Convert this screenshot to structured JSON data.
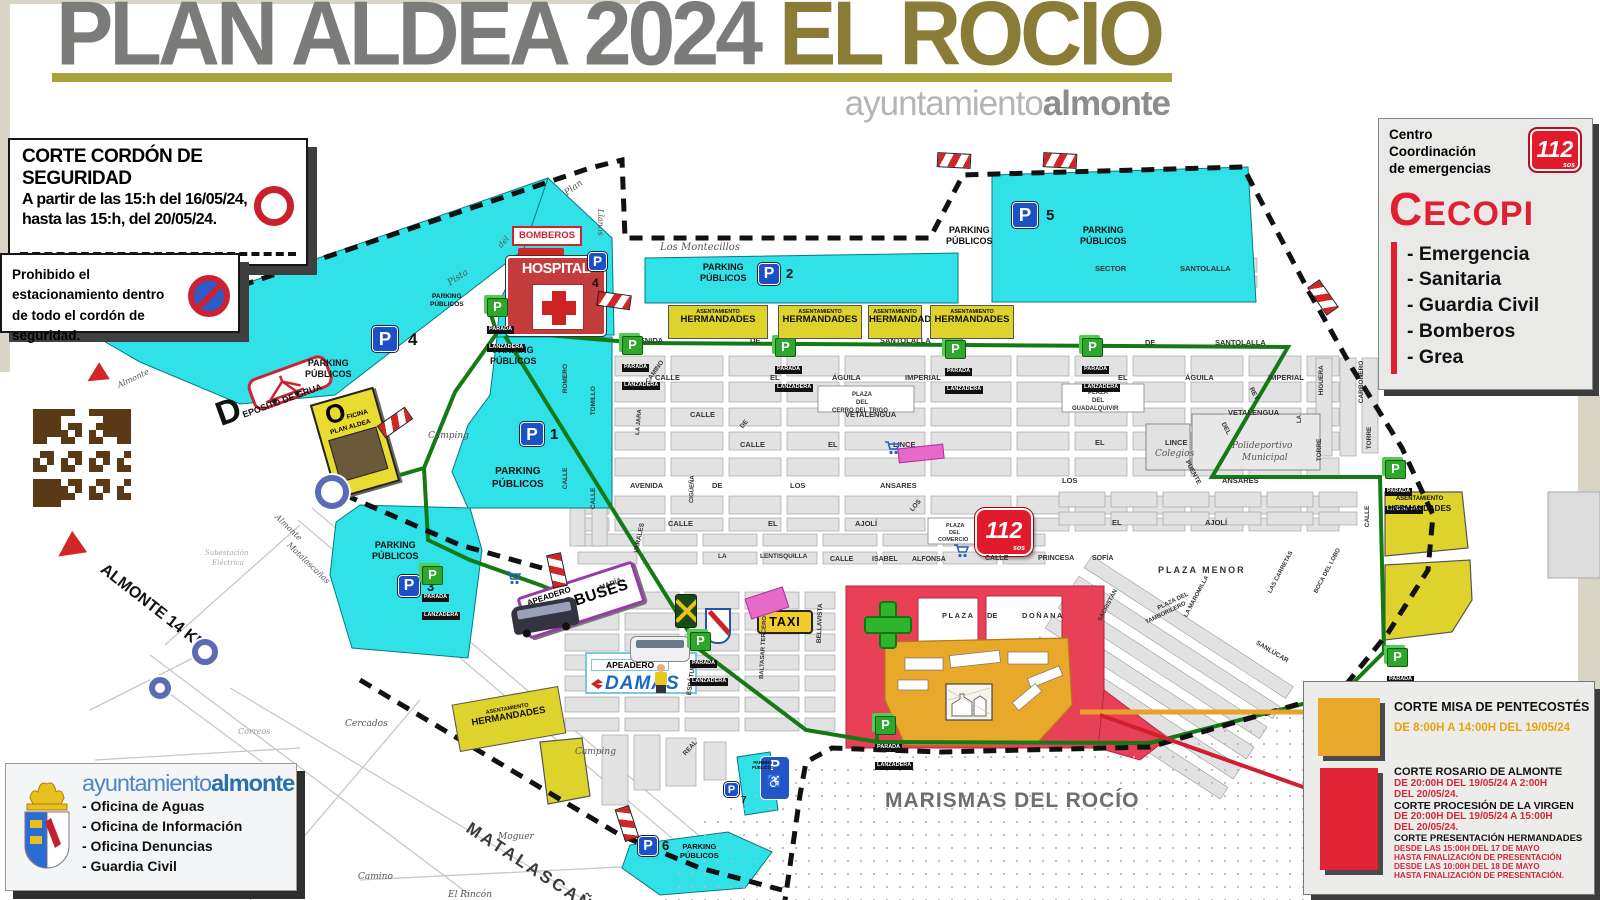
{
  "header": {
    "title_main": "PLAN ALDEA 2024 ",
    "title_accent": "EL ROCÍO",
    "brand_light": "ayuntamiento",
    "brand_bold": "almonte"
  },
  "security_box": {
    "title": "CORTE CORDÓN DE SEGURIDAD",
    "line1": "A partir de las 15:h del 16/05/24,",
    "line2": "hasta las 15:h, del 20/05/24."
  },
  "no_parking_box": {
    "line1": "Prohibido el estacionamiento dentro",
    "line2": "de todo el cordón de seguridad."
  },
  "cecopi": {
    "center_line1": "Centro",
    "center_line2": "Coordinación",
    "center_line3": "de emergencias",
    "logo": "112",
    "logo_sub": "sos",
    "name_first": "C",
    "name_rest": "ECOPI",
    "items": [
      "- Emergencia",
      "- Sanitaria",
      "- Guardia Civil",
      "- Bomberos",
      "- Grea"
    ]
  },
  "council_box": {
    "brand_light": "ayuntamiento",
    "brand_bold": "almonte",
    "items": [
      "- Oficina de Aguas",
      "- Oficina de Información",
      "- Oficina Denuncias",
      "- Guardia Civil"
    ]
  },
  "legend": {
    "misa_title": "CORTE MISA DE PENTECOSTÉS",
    "misa_time": "DE 8:00H A 14:00H DEL 19/05/24",
    "rosario_title": "CORTE ROSARIO DE ALMONTE",
    "rosario_time1": "DE 20:00H DEL 19/05/24 A 2:00H",
    "rosario_time2": "DEL 20/05/24.",
    "procesion_title": "CORTE PROCESIÓN DE LA VIRGEN",
    "procesion_time1": "DE 20:00H DEL 19/05/24 A 15:00H",
    "procesion_time2": "DEL 20/05/24.",
    "presentacion_title": "CORTE PRESENTACIÓN HERMANDADES",
    "presentacion_l1": "DESDE LAS 15:00H DEL 17 DE MAYO",
    "presentacion_l2": "HASTA FINALIZACIÓN DE PRESENTACIÓN",
    "presentacion_l3": "DESDE LAS 10:00H DEL 18 DE MAYO",
    "presentacion_l4": "HASTA FINALIZACIÓN DE PRESENTACIÓN."
  },
  "map": {
    "marismas_label": "MARISMAS DEL ROCÍO",
    "hospital_label": "HOSPITAL",
    "bomberos_label": "BOMBEROS",
    "taxi_label": "TAXI",
    "apeadero_label": "APEADERO",
    "autobuses_label": "AUTOBUSES",
    "damas_label": "DAMAS",
    "oficina_first": "O",
    "oficina_rest1": "FICINA",
    "oficina_rest2": "PLAN ALDEA",
    "deposito_label": "DEPOSITO DE GRUA",
    "parada_l1": "PARADA",
    "parada_l2": "LANZADERA",
    "herm_l1": "ASENTAMIENTO",
    "herm_l2": "HERMANDADES",
    "p_letter": "P",
    "p_name1": "PARKING",
    "p_name2": "PÚBLICOS",
    "emergency_logo": "112",
    "emergency_logo_sub": "sos",
    "wheelchair": "♿",
    "street_labels": [
      {
        "t": "Pista",
        "x": 449,
        "y": 280,
        "r": -33,
        "i": 1,
        "s": 9
      },
      {
        "t": "Plan",
        "x": 566,
        "y": 190,
        "r": -36,
        "i": 1,
        "s": 9
      },
      {
        "t": "del",
        "x": 500,
        "y": 243,
        "r": -50,
        "i": 1,
        "s": 8
      },
      {
        "t": "Llanos",
        "x": 600,
        "y": 205,
        "r": 90,
        "i": 1,
        "s": 8
      },
      {
        "t": "Los Montecillos",
        "x": 660,
        "y": 243,
        "i": 1,
        "s": 10
      },
      {
        "t": "SECTOR",
        "x": 1095,
        "y": 265
      },
      {
        "t": "SANTOLALLA",
        "x": 1180,
        "y": 265
      },
      {
        "t": "AVENIDA",
        "x": 630,
        "y": 337
      },
      {
        "t": "DE",
        "x": 750,
        "y": 337
      },
      {
        "t": "SANTOLALLA",
        "x": 880,
        "y": 337
      },
      {
        "t": "DE",
        "x": 1145,
        "y": 339
      },
      {
        "t": "SANTOLALLA",
        "x": 1215,
        "y": 339
      },
      {
        "t": "CALLE",
        "x": 655,
        "y": 374
      },
      {
        "t": "EL",
        "x": 770,
        "y": 374
      },
      {
        "t": "ÁGUILA",
        "x": 832,
        "y": 374
      },
      {
        "t": "IMPERIAL",
        "x": 905,
        "y": 374
      },
      {
        "t": "EL",
        "x": 1118,
        "y": 374
      },
      {
        "t": "ÁGUILA",
        "x": 1185,
        "y": 374
      },
      {
        "t": "IMPERIAL",
        "x": 1268,
        "y": 374
      },
      {
        "t": "CALLE",
        "x": 690,
        "y": 411
      },
      {
        "t": "VETALENGUA",
        "x": 845,
        "y": 411
      },
      {
        "t": "VETALENGUA",
        "x": 1228,
        "y": 409
      },
      {
        "t": "CALLE",
        "x": 740,
        "y": 441
      },
      {
        "t": "EL",
        "x": 828,
        "y": 441
      },
      {
        "t": "LINCE",
        "x": 893,
        "y": 441
      },
      {
        "t": "EL",
        "x": 1095,
        "y": 439
      },
      {
        "t": "LINCE",
        "x": 1165,
        "y": 439
      },
      {
        "t": "AVENIDA",
        "x": 630,
        "y": 482
      },
      {
        "t": "DE",
        "x": 712,
        "y": 482
      },
      {
        "t": "LOS",
        "x": 790,
        "y": 482
      },
      {
        "t": "ANSARES",
        "x": 880,
        "y": 482
      },
      {
        "t": "LOS",
        "x": 1062,
        "y": 477
      },
      {
        "t": "ANSARES",
        "x": 1222,
        "y": 477
      },
      {
        "t": "CALLE",
        "x": 668,
        "y": 520
      },
      {
        "t": "EL",
        "x": 768,
        "y": 520
      },
      {
        "t": "AJOLÍ",
        "x": 855,
        "y": 520
      },
      {
        "t": "EL",
        "x": 1112,
        "y": 519
      },
      {
        "t": "AJOLÍ",
        "x": 1205,
        "y": 519
      },
      {
        "t": "CALLE",
        "x": 830,
        "y": 556,
        "s": 7
      },
      {
        "t": "ISABEL",
        "x": 872,
        "y": 556,
        "s": 7
      },
      {
        "t": "ALFONSA",
        "x": 912,
        "y": 556,
        "s": 7
      },
      {
        "t": "CALLE",
        "x": 985,
        "y": 555,
        "s": 7
      },
      {
        "t": "PRINCESA",
        "x": 1038,
        "y": 555,
        "s": 7
      },
      {
        "t": "SOFÍA",
        "x": 1092,
        "y": 555,
        "s": 7
      },
      {
        "t": "LA",
        "x": 718,
        "y": 554,
        "s": 6.5
      },
      {
        "t": "LENTISQUILLA",
        "x": 760,
        "y": 554,
        "s": 6.5
      },
      {
        "t": "PLAZA MENOR",
        "x": 1158,
        "y": 566,
        "s": 9,
        "ls": 2
      },
      {
        "t": "PLAZA",
        "x": 942,
        "y": 612,
        "ls": 1.5
      },
      {
        "t": "DE",
        "x": 987,
        "y": 612
      },
      {
        "t": "DOÑANA",
        "x": 1022,
        "y": 612,
        "ls": 1.5
      },
      {
        "t": "Colegios",
        "x": 1155,
        "y": 450,
        "i": 1,
        "s": 9
      },
      {
        "t": "Polideportivo",
        "x": 1232,
        "y": 442,
        "i": 1,
        "s": 9
      },
      {
        "t": "Municipal",
        "x": 1242,
        "y": 454,
        "i": 1,
        "s": 9
      },
      {
        "t": "PLAZA",
        "x": 1088,
        "y": 390,
        "s": 6
      },
      {
        "t": "DEL",
        "x": 1092,
        "y": 398,
        "s": 6
      },
      {
        "t": "GUADALQUIVIR",
        "x": 1072,
        "y": 406,
        "s": 6
      },
      {
        "t": "PLAZA",
        "x": 852,
        "y": 392,
        "s": 6
      },
      {
        "t": "DEL",
        "x": 856,
        "y": 400,
        "s": 6
      },
      {
        "t": "CERRO DEL TRIGO",
        "x": 832,
        "y": 408,
        "s": 6
      },
      {
        "t": "PLAZA",
        "x": 946,
        "y": 524,
        "s": 5.5
      },
      {
        "t": "DEL",
        "x": 949,
        "y": 531,
        "s": 5.5
      },
      {
        "t": "COMERCIO",
        "x": 938,
        "y": 538,
        "s": 5.5
      },
      {
        "t": "PLAZA DEL",
        "x": 1158,
        "y": 606,
        "s": 6,
        "r": -26
      },
      {
        "t": "TAMBORILERO",
        "x": 1146,
        "y": 620,
        "s": 6,
        "r": -26
      },
      {
        "t": "Camping",
        "x": 428,
        "y": 432,
        "i": 1,
        "s": 9
      },
      {
        "t": "Camping",
        "x": 575,
        "y": 748,
        "i": 1,
        "s": 9
      },
      {
        "t": "Cercados",
        "x": 345,
        "y": 720,
        "i": 1,
        "s": 9
      },
      {
        "t": "Moguer",
        "x": 498,
        "y": 833,
        "i": 1,
        "s": 9
      },
      {
        "t": "Camino",
        "x": 358,
        "y": 873,
        "i": 1,
        "s": 9
      },
      {
        "t": "El Rincón",
        "x": 448,
        "y": 891,
        "i": 1,
        "s": 9
      },
      {
        "t": "Correos",
        "x": 238,
        "y": 728,
        "i": 1,
        "s": 8,
        "c": "#999"
      },
      {
        "t": "Subestación",
        "x": 205,
        "y": 550,
        "i": 1,
        "s": 7,
        "c": "#aaa"
      },
      {
        "t": "Eléctrica",
        "x": 212,
        "y": 560,
        "i": 1,
        "s": 7,
        "c": "#aaa"
      },
      {
        "t": "MATALASCAÑAS",
        "x": 468,
        "y": 818,
        "r": 33,
        "s": 17,
        "ls": 3,
        "c": "#3a3a3a"
      },
      {
        "t": "ALMONTE 14 KM",
        "x": 102,
        "y": 560,
        "r": 38,
        "s": 16,
        "c": "#111"
      },
      {
        "t": "Almonte",
        "x": 118,
        "y": 382,
        "r": -25,
        "i": 1,
        "s": 8
      },
      {
        "t": "Almonte",
        "x": 276,
        "y": 512,
        "r": 44,
        "i": 1,
        "s": 8
      },
      {
        "t": "Matalascañas",
        "x": 288,
        "y": 540,
        "r": 44,
        "i": 1,
        "s": 8
      },
      {
        "t": "ROMERO",
        "x": 566,
        "y": 390,
        "r": -90,
        "s": 6.5
      },
      {
        "t": "TOMILLO",
        "x": 594,
        "y": 412,
        "r": -90,
        "s": 6.5
      },
      {
        "t": "CALLE",
        "x": 566,
        "y": 486,
        "r": -90,
        "s": 6.5
      },
      {
        "t": "CALLE",
        "x": 594,
        "y": 506,
        "r": -90,
        "s": 6.5
      },
      {
        "t": "CAMINO",
        "x": 648,
        "y": 380,
        "r": -55,
        "s": 6.5
      },
      {
        "t": "LA JARA",
        "x": 638,
        "y": 432,
        "r": -85,
        "s": 6
      },
      {
        "t": "CIGÜEÑA",
        "x": 692,
        "y": 500,
        "r": -88,
        "s": 6
      },
      {
        "t": "DE",
        "x": 742,
        "y": 425,
        "r": -50,
        "s": 6.5
      },
      {
        "t": "LOS",
        "x": 912,
        "y": 508,
        "r": -50,
        "s": 6.5
      },
      {
        "t": "HIGUERA",
        "x": 1322,
        "y": 392,
        "r": -90,
        "s": 6.5
      },
      {
        "t": "CARBONERO",
        "x": 1362,
        "y": 400,
        "r": -90,
        "s": 6.5
      },
      {
        "t": "LA",
        "x": 1300,
        "y": 420,
        "r": -90,
        "s": 6
      },
      {
        "t": "TORRE",
        "x": 1320,
        "y": 458,
        "r": -90,
        "s": 6.5
      },
      {
        "t": "TORRE",
        "x": 1370,
        "y": 446,
        "r": -90,
        "s": 6.5
      },
      {
        "t": "CALLE",
        "x": 1368,
        "y": 524,
        "r": -90,
        "s": 6.5
      },
      {
        "t": "REY",
        "x": 1250,
        "y": 385,
        "r": 62,
        "s": 6.5
      },
      {
        "t": "DEL",
        "x": 1222,
        "y": 420,
        "r": 62,
        "s": 6.5
      },
      {
        "t": "PUENTE",
        "x": 1186,
        "y": 458,
        "r": 62,
        "s": 6.5
      },
      {
        "t": "SACRISTÁN",
        "x": 1100,
        "y": 618,
        "r": -62,
        "s": 6
      },
      {
        "t": "LA MAROMILLA",
        "x": 1186,
        "y": 614,
        "r": -62,
        "s": 6
      },
      {
        "t": "LAS CARRETAS",
        "x": 1270,
        "y": 590,
        "r": -62,
        "s": 6
      },
      {
        "t": "BOCA DEL LOBO",
        "x": 1316,
        "y": 590,
        "r": -62,
        "s": 6
      },
      {
        "t": "SANLÚCAR",
        "x": 1256,
        "y": 640,
        "r": 31,
        "s": 6.5
      },
      {
        "t": "ESPÁTULA",
        "x": 690,
        "y": 692,
        "r": -82,
        "s": 6.5
      },
      {
        "t": "BALTASAR TERCERO",
        "x": 762,
        "y": 676,
        "r": -87,
        "s": 6
      },
      {
        "t": "VARALES",
        "x": 637,
        "y": 550,
        "r": -78,
        "s": 6.5
      },
      {
        "t": "MARÍA",
        "x": 600,
        "y": 585,
        "r": -20,
        "s": 7
      },
      {
        "t": "REAL",
        "x": 685,
        "y": 752,
        "r": -48,
        "s": 6.5
      },
      {
        "t": "BELLAVISTA",
        "x": 820,
        "y": 640,
        "r": -88,
        "s": 6.5
      }
    ],
    "parking_badges": [
      {
        "x": 372,
        "y": 326,
        "s": 26,
        "num": "4",
        "nx": 408,
        "ny": 330,
        "ns": 17
      },
      {
        "x": 520,
        "y": 422,
        "s": 24,
        "num": "1",
        "nx": 550,
        "ny": 426,
        "ns": 15
      },
      {
        "x": 758,
        "y": 263,
        "s": 22,
        "num": "2",
        "nx": 786,
        "ny": 266,
        "ns": 13
      },
      {
        "x": 1012,
        "y": 202,
        "s": 26,
        "num": "5",
        "nx": 1046,
        "ny": 207,
        "ns": 15
      },
      {
        "x": 398,
        "y": 575,
        "s": 22,
        "num": "3",
        "nx": 427,
        "ny": 579,
        "ns": 13
      },
      {
        "x": 638,
        "y": 836,
        "s": 20,
        "num": "6",
        "nx": 662,
        "ny": 838,
        "ns": 13
      },
      {
        "x": 724,
        "y": 782,
        "s": 15,
        "num": "7",
        "nx": 741,
        "ny": 795,
        "ns": 10
      },
      {
        "x": 588,
        "y": 252,
        "s": 19,
        "num": "4",
        "nx": 592,
        "ny": 276,
        "ns": 12
      }
    ],
    "parking_names": [
      {
        "x": 430,
        "y": 293,
        "s": 6.5
      },
      {
        "x": 305,
        "y": 358,
        "s": 9
      },
      {
        "x": 490,
        "y": 345,
        "s": 9
      },
      {
        "x": 492,
        "y": 466,
        "s": 10
      },
      {
        "x": 700,
        "y": 262,
        "s": 9
      },
      {
        "x": 946,
        "y": 225,
        "s": 9
      },
      {
        "x": 1080,
        "y": 225,
        "s": 9
      },
      {
        "x": 372,
        "y": 540,
        "s": 9
      },
      {
        "x": 680,
        "y": 842,
        "s": 7.5
      },
      {
        "x": 752,
        "y": 760,
        "s": 4.2
      }
    ],
    "paradas": [
      {
        "x": 487,
        "y": 298
      },
      {
        "x": 622,
        "y": 336
      },
      {
        "x": 775,
        "y": 338
      },
      {
        "x": 945,
        "y": 340
      },
      {
        "x": 1082,
        "y": 338
      },
      {
        "x": 1385,
        "y": 460
      },
      {
        "x": 1387,
        "y": 648
      },
      {
        "x": 422,
        "y": 566
      },
      {
        "x": 690,
        "y": 632
      },
      {
        "x": 875,
        "y": 716
      }
    ],
    "closures": [
      {
        "x": 378,
        "y": 415,
        "r": -35
      },
      {
        "x": 597,
        "y": 293,
        "r": 8
      },
      {
        "x": 937,
        "y": 153,
        "r": 3
      },
      {
        "x": 1043,
        "y": 153,
        "r": 3
      },
      {
        "x": 1306,
        "y": 290,
        "r": 55
      },
      {
        "x": 540,
        "y": 563,
        "r": 78
      },
      {
        "x": 610,
        "y": 816,
        "r": 72
      }
    ],
    "roundabouts": [
      {
        "x": 332,
        "y": 492,
        "r": 17
      },
      {
        "x": 205,
        "y": 652,
        "r": 13
      },
      {
        "x": 160,
        "y": 688,
        "r": 11
      }
    ],
    "arrows": [
      {
        "x": 86,
        "y": 366,
        "r": -32,
        "s": 20
      },
      {
        "x": 56,
        "y": 536,
        "r": -35,
        "s": 26
      }
    ],
    "carts": [
      {
        "x": 505,
        "y": 570
      },
      {
        "x": 884,
        "y": 440
      },
      {
        "x": 953,
        "y": 543
      }
    ],
    "pinks": [
      {
        "x": 898,
        "y": 446,
        "w": 46,
        "h": 15,
        "r": -6
      },
      {
        "x": 747,
        "y": 592,
        "w": 40,
        "h": 22,
        "r": -18
      }
    ],
    "herm_boxes": [
      {
        "x": 668,
        "y": 305,
        "w": 100
      },
      {
        "x": 778,
        "y": 305,
        "w": 84
      },
      {
        "x": 868,
        "y": 305,
        "w": 54
      },
      {
        "x": 930,
        "y": 305,
        "w": 84
      }
    ],
    "herm_right_label": {
      "x": 1388,
      "y": 496
    },
    "herm_sw_label": {
      "x": 455,
      "y": 695,
      "w": 108,
      "r": -10
    }
  },
  "colors": {
    "accent_olive": "#8a7b36",
    "title_gray": "#7b7b79",
    "parking_cyan": "#30e2e8",
    "hermandades_yellow": "#ded32c",
    "misa_orange": "#e8a82a",
    "procession_red": "#e84057",
    "legend_red": "#d2293a",
    "green_route": "#157a15",
    "cecopi_red": "#e02030",
    "parking_blue": "#1b50c8"
  }
}
